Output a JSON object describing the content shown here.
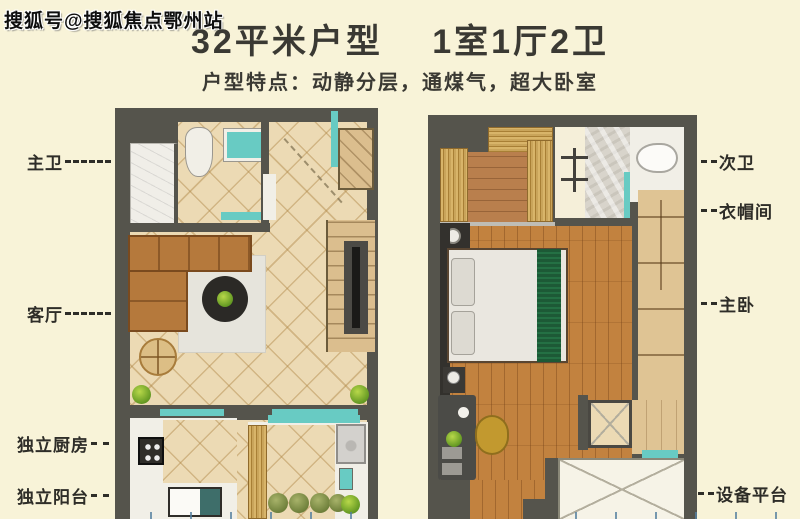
{
  "watermark": "搜狐号@搜狐焦点鄂州站",
  "header": {
    "title": "32平米户型　 1室1厅2卫",
    "subtitle": "户型特点：动静分层，通煤气，超大卧室"
  },
  "floor_plans": {
    "left": {
      "labels": [
        "主卫",
        "客厅",
        "独立厨房",
        "独立阳台"
      ]
    },
    "right": {
      "labels": [
        "次卫",
        "衣帽间",
        "主卧",
        "设备平台"
      ]
    }
  },
  "colors": {
    "background": "#F8F3D8",
    "wall": "#55544C",
    "tile_floor": "#ECDAB4",
    "wood_floor": "#C2823F",
    "window_teal": "#68CBC3",
    "sofa_brown": "#B5793C",
    "blanket_green": "#1D5936",
    "text": "#2E2D28"
  }
}
